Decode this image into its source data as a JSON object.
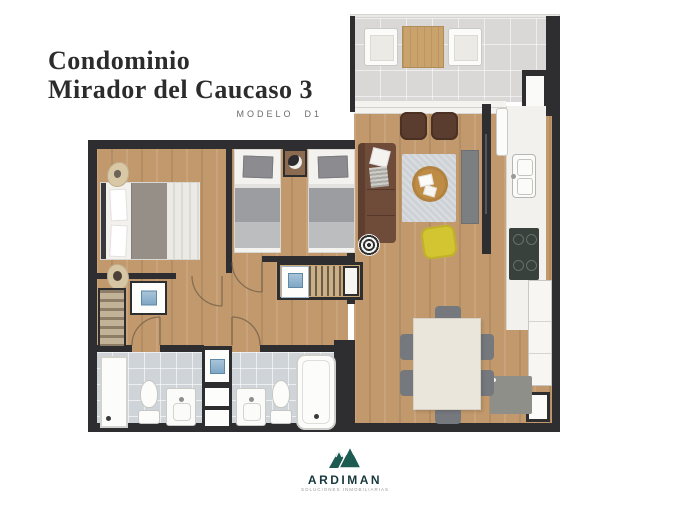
{
  "header": {
    "title_line1": "Condominio",
    "title_line2": "Mirador del Caucaso 3",
    "model_label": "MODELO  D1"
  },
  "brand": {
    "name": "ARDIMAN",
    "tagline": "SOLUCIONES INMOBILIARIAS",
    "logo_color": "#1d5a52"
  },
  "palette": {
    "wall": "#2e2e30",
    "wood_floor": "#c2996c",
    "balcony_tile": "#d9d8d6",
    "bathroom_tile": "#cfd4d8",
    "sofa_brown": "#6f4b39",
    "accent_chair_yellow": "#d3c431",
    "rug_gray": "#ced2d6",
    "coffee_table_tan": "#bf8c45",
    "dining_table_cream": "#eae6db",
    "logo_teal": "#1d5a52"
  },
  "floorplan": {
    "type": "apartment-floor-plan",
    "rooms": [
      {
        "name": "balcony",
        "furniture": [
          "armchair",
          "wood-side-table",
          "armchair"
        ]
      },
      {
        "name": "living-room",
        "furniture": [
          "sofa",
          "two-armchairs",
          "rug",
          "round-coffee-table",
          "yellow-accent-chair",
          "tv-console",
          "tv-panel",
          "round-side-table"
        ]
      },
      {
        "name": "kitchen",
        "furniture": [
          "counter",
          "sink",
          "cooktop",
          "refrigerator",
          "cabinets"
        ]
      },
      {
        "name": "dining-area",
        "furniture": [
          "dining-table",
          "six-chairs",
          "gray-appliance"
        ]
      },
      {
        "name": "bedroom-1",
        "furniture": [
          "double-bed",
          "shelf-closet",
          "dresser"
        ]
      },
      {
        "name": "bedroom-2",
        "furniture": [
          "twin-bed",
          "nightstand-with-lamp",
          "twin-bed",
          "wardrobe-unit"
        ]
      },
      {
        "name": "bathroom-1",
        "furniture": [
          "shower",
          "toilet",
          "sink-vanity"
        ]
      },
      {
        "name": "bathroom-2",
        "furniture": [
          "sink-vanity",
          "toilet",
          "bathtub"
        ]
      },
      {
        "name": "hallway",
        "furniture": [
          "door-swings"
        ]
      }
    ]
  }
}
